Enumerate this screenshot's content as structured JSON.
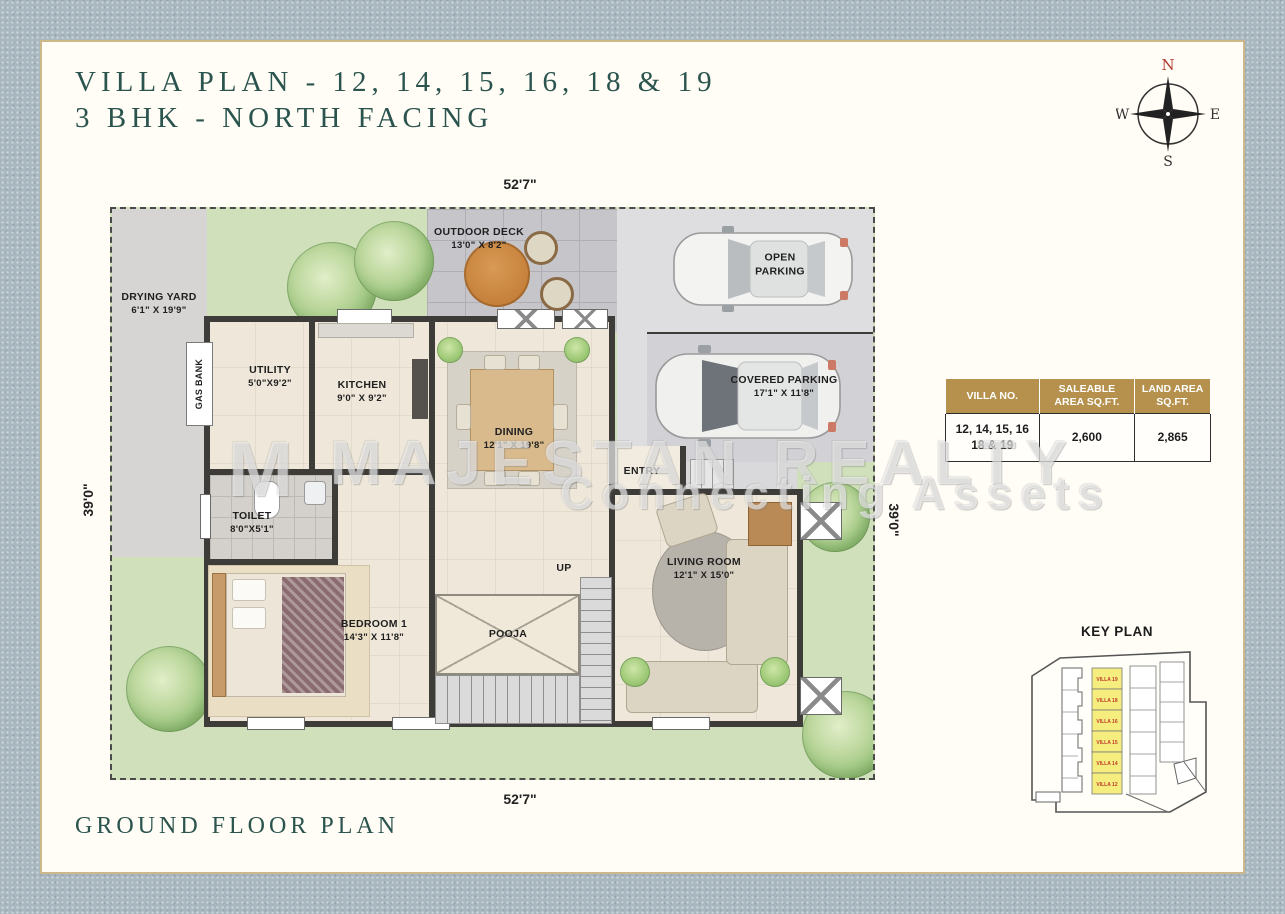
{
  "page": {
    "title_line1": "VILLA PLAN - 12, 14, 15, 16, 18 & 19",
    "title_line2": "3 BHK - NORTH FACING",
    "footer_title": "GROUND FLOOR PLAN"
  },
  "watermark": {
    "mark": "M",
    "line1": "MAJESTAN REALTY",
    "line2": "Connecting Assets"
  },
  "compass": {
    "north": "N",
    "east": "E",
    "south": "S",
    "west": "W"
  },
  "plot_dimensions": {
    "top": "52'7\"",
    "bottom": "52'7\"",
    "left": "39'0\"",
    "right": "39'0\""
  },
  "rooms": {
    "drying_yard": {
      "name": "DRYING YARD",
      "size": "6'1\" X 19'9\""
    },
    "gas_bank": {
      "name": "GAS BANK"
    },
    "utility": {
      "name": "UTILITY",
      "size": "5'0\"X9'2\""
    },
    "kitchen": {
      "name": "KITCHEN",
      "size": "9'0\" X 9'2\""
    },
    "outdoor_deck": {
      "name": "OUTDOOR DECK",
      "size": "13'0\" X 8'2\""
    },
    "open_parking": {
      "name": "OPEN PARKING"
    },
    "covered_parking": {
      "name": "COVERED PARKING",
      "size": "17'1\" X 11'8\""
    },
    "dining": {
      "name": "DINING",
      "size": "12'1\" X 19'8\""
    },
    "entry": {
      "name": "ENTRY"
    },
    "toilet": {
      "name": "TOILET",
      "size": "8'0\"X5'1\""
    },
    "bedroom1": {
      "name": "BEDROOM 1",
      "size": "14'3\" X 11'8\""
    },
    "pooja": {
      "name": "POOJA"
    },
    "up": {
      "name": "UP"
    },
    "living_room": {
      "name": "LIVING ROOM",
      "size": "12'1\" X 15'0\""
    }
  },
  "area_table": {
    "headers": [
      "VILLA NO.",
      "SALEABLE AREA SQ.FT.",
      "LAND AREA SQ.FT."
    ],
    "row": {
      "villa_no": "12, 14, 15, 16 18 & 19",
      "saleable_area": "2,600",
      "land_area": "2,865"
    }
  },
  "key_plan": {
    "title": "KEY PLAN",
    "highlighted_villas": [
      "VILLA 19",
      "VILLA 18",
      "VILLA 16",
      "VILLA 15",
      "VILLA 14",
      "VILLA 12"
    ]
  },
  "colors": {
    "accent_teal": "#2b544e",
    "table_header_gold": "#b5914d",
    "card_border_gold": "#cdb88a",
    "keyplan_highlight": "#f5ee7e",
    "compass_north_red": "#b03a2e"
  }
}
